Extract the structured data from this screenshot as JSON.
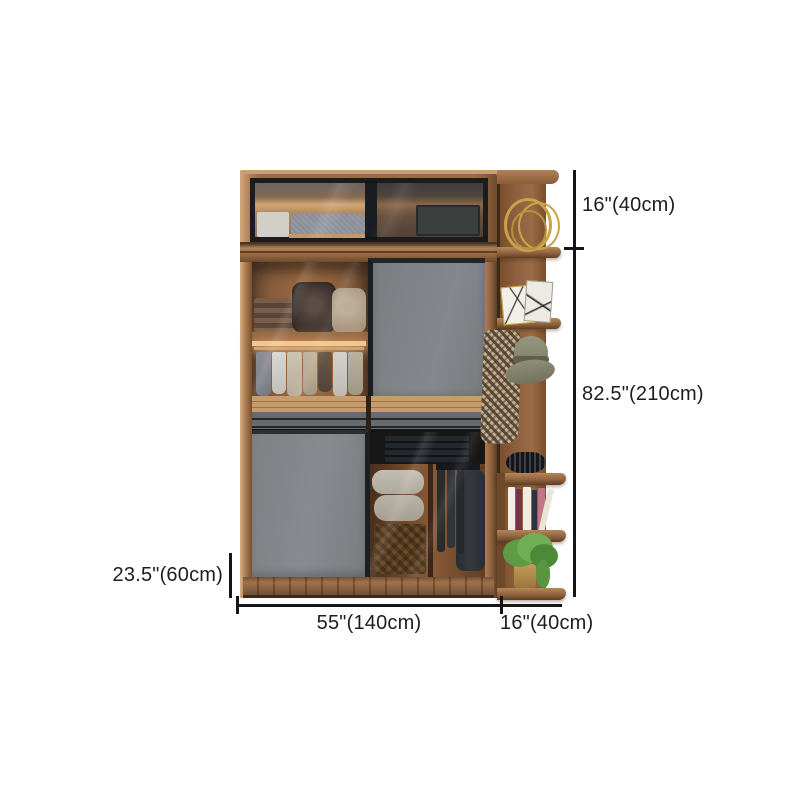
{
  "scene": {
    "background": "#ffffff"
  },
  "dimensions": {
    "upper_cabinet_height": "16\"(40cm)",
    "wardrobe_height": "82.5\"(210cm)",
    "wardrobe_depth": "23.5\"(60cm)",
    "wardrobe_width": "55\"(140cm)",
    "side_shelf_width": "16\"(40cm)"
  },
  "palette": {
    "wood": "#9a6b44",
    "wood_light": "#c9a06e",
    "wood_dark": "#6e4a2c",
    "door_gray": "#7f8285",
    "glass_frame": "#1b1c1e",
    "dimension_line": "#161616",
    "interior_glow": "#ffca8e",
    "plant_green": "#5f9a44",
    "pot_gold": "#b08d4a"
  }
}
